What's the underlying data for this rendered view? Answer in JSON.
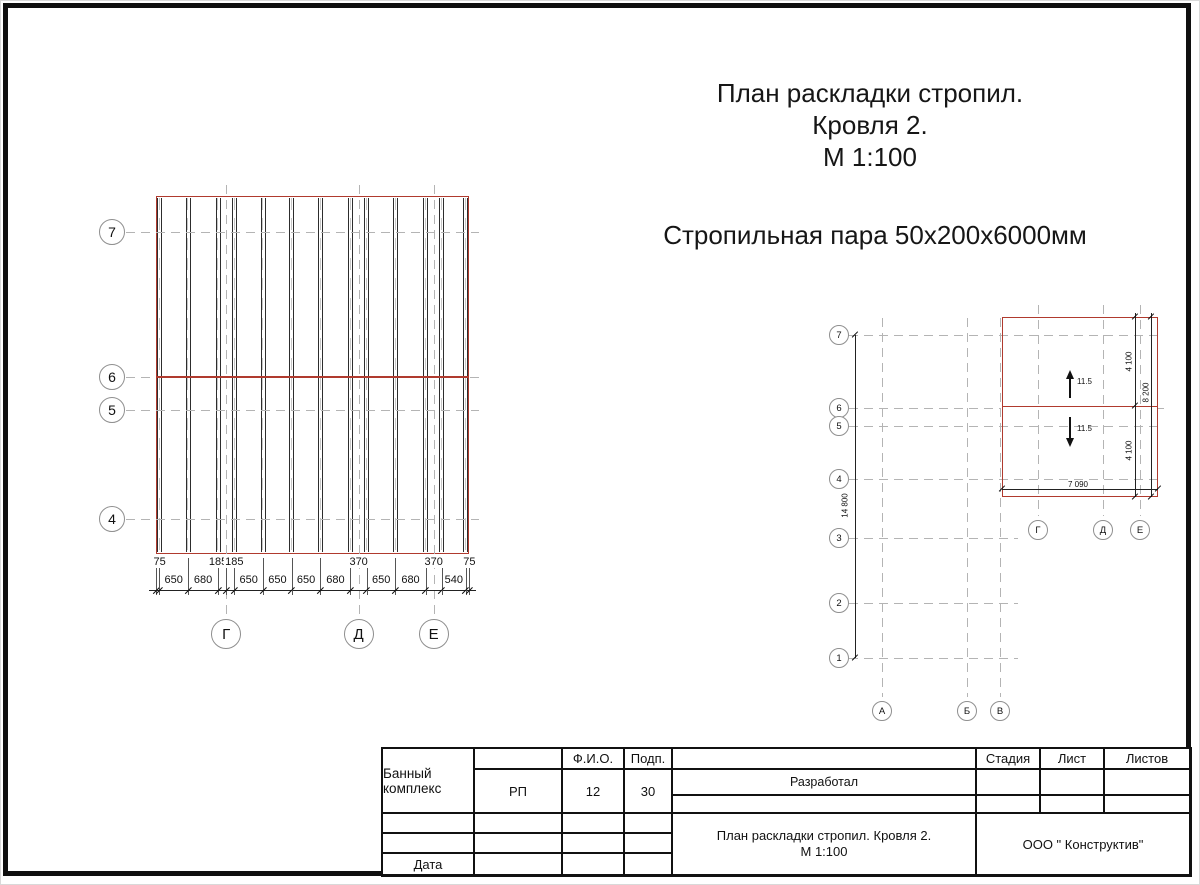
{
  "titles": {
    "main_line1": "План раскладки стропил.",
    "main_line2": "Кровля 2.",
    "main_line3": "М 1:100",
    "subtitle": "Стропильная пара 50х200х6000мм"
  },
  "colors": {
    "red": "#b03a2e",
    "dark": "#2d2d2d",
    "grid_gray": "#b4b4b4",
    "dim": "#222222"
  },
  "left_plan": {
    "left_axes": [
      "7",
      "6",
      "5",
      "4"
    ],
    "bottom_axes": [
      "Г",
      "Д",
      "Е"
    ],
    "dim_chain": [
      75,
      650,
      680,
      185,
      185,
      650,
      650,
      650,
      680,
      370,
      650,
      680,
      370,
      540,
      75
    ],
    "rafter_points": [
      1,
      2,
      3,
      5,
      6,
      7,
      8,
      9,
      10,
      11,
      12,
      13,
      14
    ],
    "upper_dims": [
      {
        "label": "75",
        "from": 0,
        "to": 1
      },
      {
        "label": "185",
        "from": 3,
        "to": 4
      },
      {
        "label": "185",
        "from": 4,
        "to": 5
      },
      {
        "label": "370",
        "from": 9,
        "to": 10
      },
      {
        "label": "370",
        "from": 12,
        "to": 13
      },
      {
        "label": "75",
        "from": 14,
        "to": 15
      }
    ],
    "lower_dims": [
      {
        "label": "650",
        "from": 1,
        "to": 2
      },
      {
        "label": "680",
        "from": 2,
        "to": 3
      },
      {
        "label": "650",
        "from": 5,
        "to": 6
      },
      {
        "label": "650",
        "from": 6,
        "to": 7
      },
      {
        "label": "650",
        "from": 7,
        "to": 8
      },
      {
        "label": "680",
        "from": 8,
        "to": 9
      },
      {
        "label": "650",
        "from": 10,
        "to": 11
      },
      {
        "label": "680",
        "from": 11,
        "to": 12
      },
      {
        "label": "540",
        "from": 13,
        "to": 14
      }
    ]
  },
  "key_plan": {
    "row_axes": [
      "7",
      "6",
      "5",
      "4",
      "3",
      "2",
      "1"
    ],
    "col_axes_bottom": [
      "А",
      "Б",
      "В"
    ],
    "col_axes_mid": [
      "Г",
      "Д",
      "Е"
    ],
    "dims": {
      "total_height": "14 800",
      "width": "7 090",
      "upper": "4 100",
      "lower": "4 100",
      "total": "8 200"
    },
    "slope_up": "11.5",
    "slope_down": "11.5"
  },
  "title_block": {
    "header_fio": "Ф.И.О.",
    "header_podp": "Подп.",
    "row_developed": "Разработал",
    "row_date": "Дата",
    "project": "Банный комплекс",
    "sheet_title_line1": "План раскладки стропил. Кровля 2.",
    "sheet_title_line2": "М 1:100",
    "stage_label": "Стадия",
    "sheet_label": "Лист",
    "sheets_label": "Листов",
    "stage_value": "РП",
    "sheet_value": "12",
    "sheets_value": "30",
    "company": "ООО \" Конструктив\""
  }
}
